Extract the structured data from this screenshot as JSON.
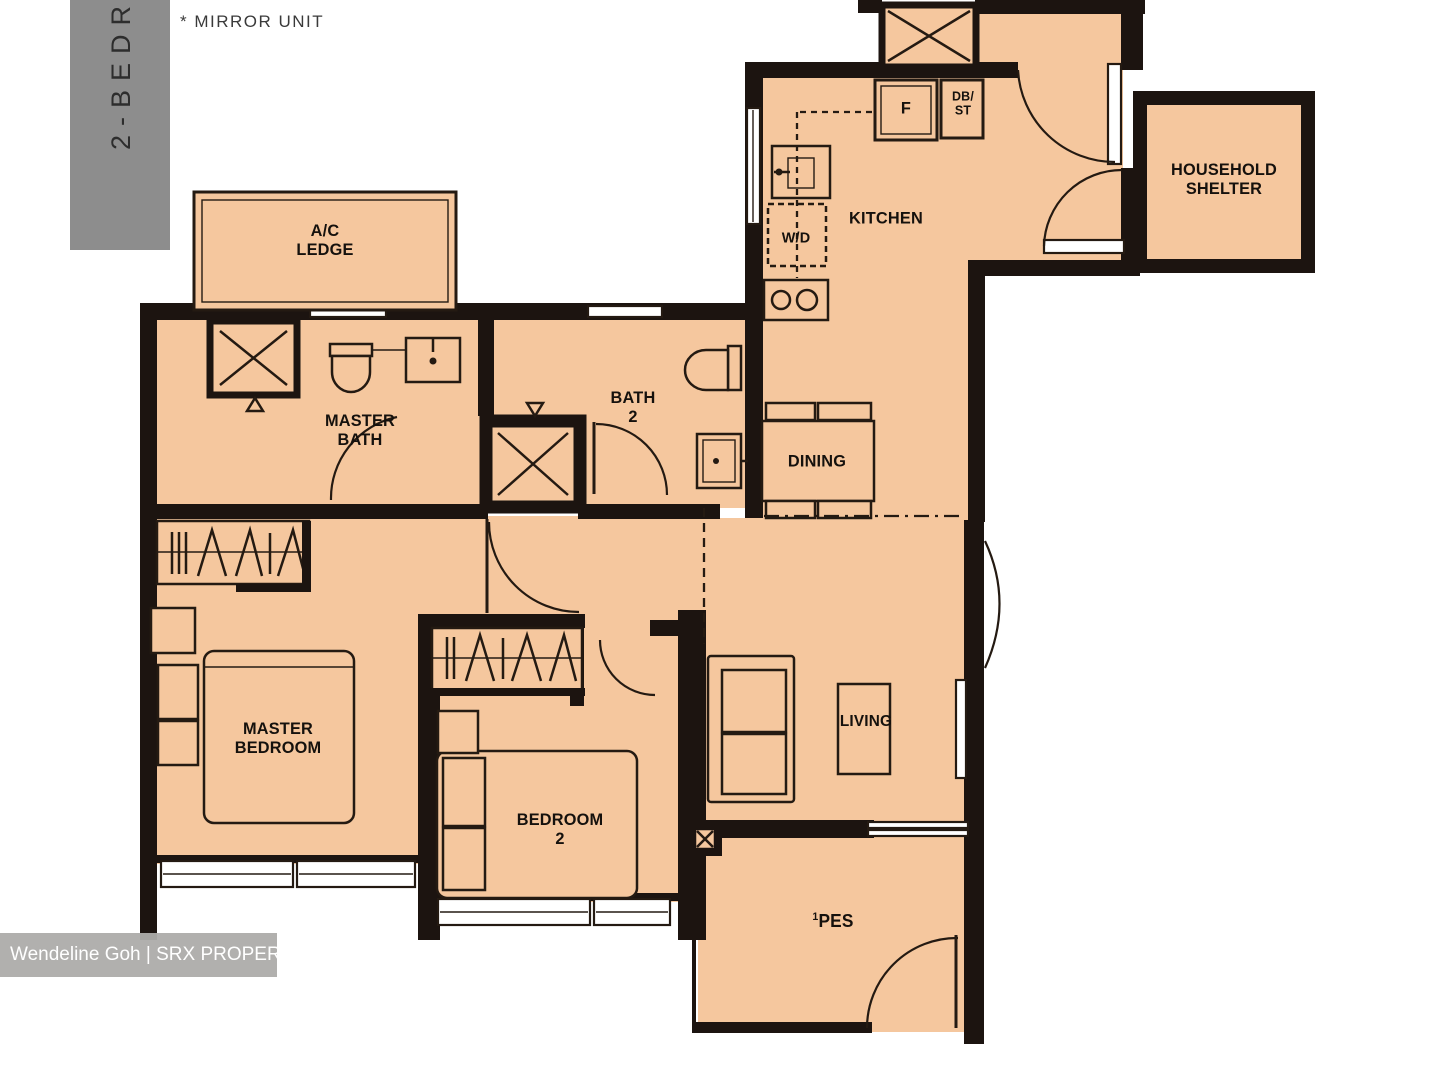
{
  "meta": {
    "unit_type_vertical": "2-BEDROOM",
    "mirror_note": "* MIRROR UNIT"
  },
  "colors": {
    "floor": "#f5c79e",
    "wall": "#1c1410",
    "tab_gray": "#8d8d8d",
    "watermark_bg": "#adacaa",
    "watermark_text": "#ffffff"
  },
  "rooms": {
    "ac_ledge": {
      "line1": "A/C",
      "line2": "LEDGE"
    },
    "master_bath": {
      "line1": "MASTER",
      "line2": "BATH"
    },
    "bath2": {
      "line1": "BATH",
      "line2": "2"
    },
    "kitchen": {
      "label": "KITCHEN"
    },
    "household_shelter": {
      "line1": "HOUSEHOLD",
      "line2": "SHELTER"
    },
    "dining": {
      "label": "DINING"
    },
    "living": {
      "label": "LIVING"
    },
    "master_bedroom": {
      "line1": "MASTER",
      "line2": "BEDROOM"
    },
    "bedroom2": {
      "line1": "BEDROOM",
      "line2": "2"
    },
    "pes": {
      "sup": "1",
      "label": "PES"
    }
  },
  "fixtures": {
    "fridge": "F",
    "db_st": {
      "line1": "DB/",
      "line2": "ST"
    },
    "washer_dryer": "W/D"
  },
  "watermark": {
    "text": "Wendeline Goh | SRX PROPERTY"
  }
}
